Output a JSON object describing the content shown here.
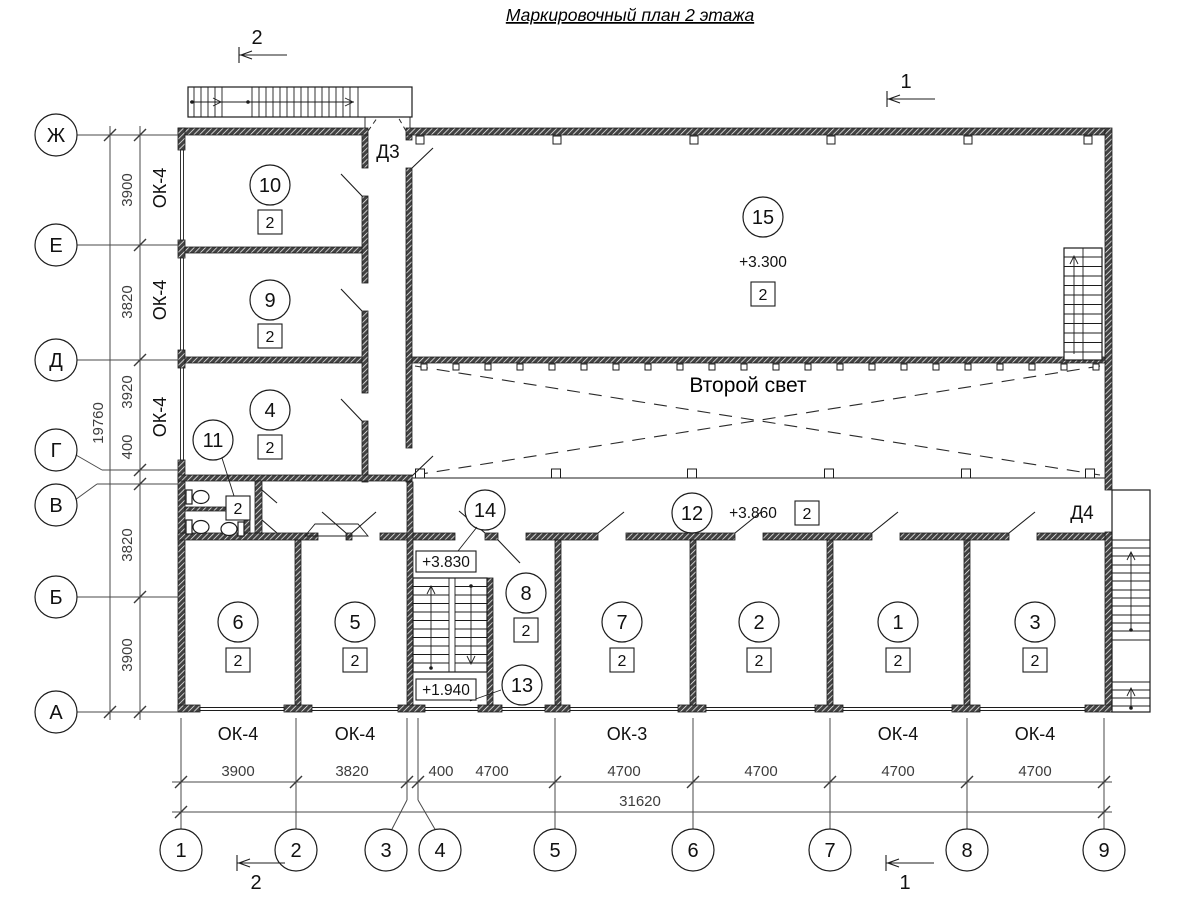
{
  "title": "Маркировочный план 2 этажа",
  "axes": {
    "left": [
      "Ж",
      "Е",
      "Д",
      "Г",
      "В",
      "Б",
      "А"
    ],
    "bottom": [
      "1",
      "2",
      "3",
      "4",
      "5",
      "6",
      "7",
      "8",
      "9"
    ]
  },
  "dims": {
    "left": {
      "segments": [
        "3900",
        "3820",
        "3920",
        "400",
        "3820",
        "3900"
      ],
      "total": "19760"
    },
    "bottom": {
      "segments": [
        "3900",
        "3820",
        "400",
        "4700",
        "4700",
        "4700",
        "4700",
        "4700"
      ],
      "total": "31620"
    }
  },
  "windows": {
    "left": [
      "ОК-4",
      "ОК-4",
      "ОК-4"
    ],
    "bottom": [
      "ОК-4",
      "ОК-4",
      "ОК-3",
      "ОК-4",
      "ОК-4"
    ]
  },
  "doors": {
    "d3": "Д3",
    "d4": "Д4"
  },
  "sections": {
    "s1": "1",
    "s2": "2"
  },
  "second_light": "Второй свет",
  "rooms": [
    {
      "num": "10",
      "cat": "2"
    },
    {
      "num": "9",
      "cat": "2"
    },
    {
      "num": "4",
      "cat": "2"
    },
    {
      "num": "11",
      "cat": "2"
    },
    {
      "num": "15",
      "cat": "2",
      "elev": "+3.300"
    },
    {
      "num": "14",
      "elev": "+3.830"
    },
    {
      "num": "12",
      "cat": "2",
      "elev": "+3.860"
    },
    {
      "num": "13",
      "elev": "+1.940"
    },
    {
      "num": "6",
      "cat": "2"
    },
    {
      "num": "5",
      "cat": "2"
    },
    {
      "num": "8",
      "cat": "2"
    },
    {
      "num": "7",
      "cat": "2"
    },
    {
      "num": "2",
      "cat": "2"
    },
    {
      "num": "1",
      "cat": "2"
    },
    {
      "num": "3",
      "cat": "2"
    }
  ]
}
